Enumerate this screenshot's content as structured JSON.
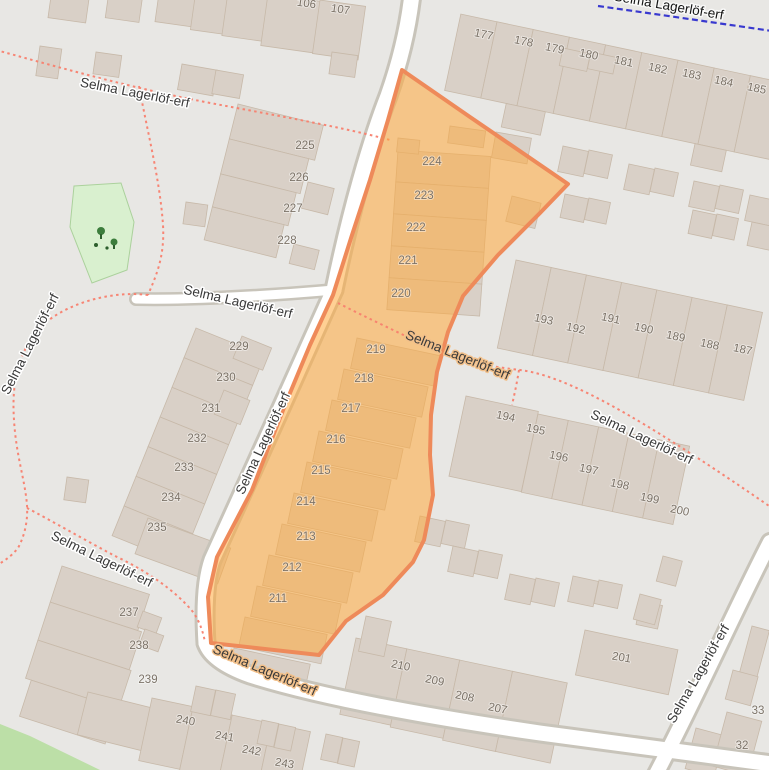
{
  "map": {
    "street_name": "Selma Lagerlöf-erf",
    "street_labels": [
      {
        "text": "Selma Lagerlöf-erf",
        "x": 134,
        "y": 97,
        "rot": 11,
        "kind": "footpath"
      },
      {
        "text": "Selma Lagerlöf-erf",
        "x": 237,
        "y": 306,
        "rot": 13,
        "kind": "road"
      },
      {
        "text": "Selma Lagerlöf-erf",
        "x": 267,
        "y": 445,
        "rot": -65,
        "kind": "road"
      },
      {
        "text": "Selma Lagerlöf-erf",
        "x": 456,
        "y": 359,
        "rot": 22,
        "kind": "footpath-on-selection"
      },
      {
        "text": "Selma Lagerlöf-erf",
        "x": 640,
        "y": 441,
        "rot": 25,
        "kind": "footpath"
      },
      {
        "text": "Selma Lagerlöf-erf",
        "x": 263,
        "y": 674,
        "rot": 23,
        "kind": "road-on-selection"
      },
      {
        "text": "Selma Lagerlöf-erf",
        "x": 34,
        "y": 346,
        "rot": -63,
        "kind": "footpath"
      },
      {
        "text": "Selma Lagerlöf-erf",
        "x": 100,
        "y": 563,
        "rot": 26,
        "kind": "footpath"
      },
      {
        "text": "Selma Lagerlöf-erf",
        "x": 702,
        "y": 676,
        "rot": -60,
        "kind": "road"
      },
      {
        "text": "Selma Lagerlöf-erf",
        "x": 668,
        "y": 10,
        "rot": 10,
        "kind": "cycleway"
      }
    ],
    "house_numbers": [
      {
        "t": "106",
        "x": 306,
        "y": 7,
        "r": 8
      },
      {
        "t": "107",
        "x": 340,
        "y": 13,
        "r": 8
      },
      {
        "t": "177",
        "x": 483,
        "y": 38,
        "r": 12
      },
      {
        "t": "178",
        "x": 523,
        "y": 45,
        "r": 12
      },
      {
        "t": "179",
        "x": 554,
        "y": 52,
        "r": 12
      },
      {
        "t": "180",
        "x": 588,
        "y": 58,
        "r": 12
      },
      {
        "t": "181",
        "x": 623,
        "y": 65,
        "r": 12
      },
      {
        "t": "182",
        "x": 657,
        "y": 72,
        "r": 12
      },
      {
        "t": "183",
        "x": 691,
        "y": 78,
        "r": 12
      },
      {
        "t": "184",
        "x": 723,
        "y": 85,
        "r": 12
      },
      {
        "t": "185",
        "x": 756,
        "y": 92,
        "r": 12
      },
      {
        "t": "225",
        "x": 305,
        "y": 149,
        "r": 0
      },
      {
        "t": "226",
        "x": 299,
        "y": 181,
        "r": 0
      },
      {
        "t": "227",
        "x": 293,
        "y": 212,
        "r": 0
      },
      {
        "t": "228",
        "x": 287,
        "y": 244,
        "r": 0
      },
      {
        "t": "224",
        "x": 432,
        "y": 165,
        "r": 0
      },
      {
        "t": "223",
        "x": 424,
        "y": 199,
        "r": 0
      },
      {
        "t": "222",
        "x": 416,
        "y": 231,
        "r": 0
      },
      {
        "t": "221",
        "x": 408,
        "y": 264,
        "r": 0
      },
      {
        "t": "220",
        "x": 401,
        "y": 297,
        "r": 0
      },
      {
        "t": "219",
        "x": 376,
        "y": 353,
        "r": 0
      },
      {
        "t": "218",
        "x": 364,
        "y": 382,
        "r": 0
      },
      {
        "t": "217",
        "x": 351,
        "y": 412,
        "r": 0
      },
      {
        "t": "216",
        "x": 336,
        "y": 443,
        "r": 0
      },
      {
        "t": "215",
        "x": 321,
        "y": 474,
        "r": 0
      },
      {
        "t": "214",
        "x": 306,
        "y": 505,
        "r": 0
      },
      {
        "t": "213",
        "x": 306,
        "y": 540,
        "r": 0
      },
      {
        "t": "212",
        "x": 292,
        "y": 571,
        "r": 0
      },
      {
        "t": "211",
        "x": 278,
        "y": 602,
        "r": 0
      },
      {
        "t": "229",
        "x": 239,
        "y": 350,
        "r": 0
      },
      {
        "t": "230",
        "x": 226,
        "y": 381,
        "r": 0
      },
      {
        "t": "231",
        "x": 211,
        "y": 412,
        "r": 0
      },
      {
        "t": "232",
        "x": 197,
        "y": 442,
        "r": 0
      },
      {
        "t": "233",
        "x": 184,
        "y": 471,
        "r": 0
      },
      {
        "t": "234",
        "x": 171,
        "y": 501,
        "r": 0
      },
      {
        "t": "235",
        "x": 157,
        "y": 531,
        "r": 0
      },
      {
        "t": "237",
        "x": 129,
        "y": 616,
        "r": 0
      },
      {
        "t": "238",
        "x": 139,
        "y": 649,
        "r": 0
      },
      {
        "t": "239",
        "x": 148,
        "y": 683,
        "r": 0
      },
      {
        "t": "240",
        "x": 185,
        "y": 724,
        "r": 10
      },
      {
        "t": "241",
        "x": 224,
        "y": 740,
        "r": 10
      },
      {
        "t": "242",
        "x": 251,
        "y": 754,
        "r": 10
      },
      {
        "t": "243",
        "x": 284,
        "y": 767,
        "r": 10
      },
      {
        "t": "210",
        "x": 400,
        "y": 669,
        "r": 12
      },
      {
        "t": "209",
        "x": 434,
        "y": 684,
        "r": 12
      },
      {
        "t": "208",
        "x": 464,
        "y": 700,
        "r": 12
      },
      {
        "t": "207",
        "x": 497,
        "y": 712,
        "r": 12
      },
      {
        "t": "193",
        "x": 543,
        "y": 323,
        "r": 12
      },
      {
        "t": "192",
        "x": 575,
        "y": 332,
        "r": 12
      },
      {
        "t": "191",
        "x": 610,
        "y": 322,
        "r": 12
      },
      {
        "t": "190",
        "x": 643,
        "y": 332,
        "r": 12
      },
      {
        "t": "189",
        "x": 675,
        "y": 340,
        "r": 12
      },
      {
        "t": "188",
        "x": 709,
        "y": 348,
        "r": 12
      },
      {
        "t": "187",
        "x": 742,
        "y": 353,
        "r": 12
      },
      {
        "t": "194",
        "x": 505,
        "y": 420,
        "r": 12
      },
      {
        "t": "195",
        "x": 535,
        "y": 433,
        "r": 12
      },
      {
        "t": "196",
        "x": 558,
        "y": 460,
        "r": 12
      },
      {
        "t": "197",
        "x": 588,
        "y": 473,
        "r": 12
      },
      {
        "t": "198",
        "x": 619,
        "y": 488,
        "r": 12
      },
      {
        "t": "199",
        "x": 649,
        "y": 502,
        "r": 12
      },
      {
        "t": "200",
        "x": 679,
        "y": 514,
        "r": 12
      },
      {
        "t": "201",
        "x": 621,
        "y": 661,
        "r": 10
      },
      {
        "t": "33",
        "x": 758,
        "y": 714,
        "r": 0
      },
      {
        "t": "32",
        "x": 742,
        "y": 749,
        "r": 0
      }
    ],
    "colors": {
      "land": "#e8e7e4",
      "building": "#d9d0c7",
      "building_outline": "#c7b9a9",
      "road_fill": "#ffffff",
      "road_casing": "#c8c4ba",
      "footpath": "#f87f6e",
      "cycleway": "#3939cf",
      "park": "#d9f0cf",
      "park_outline": "#abd19c",
      "grass": "#bcdfa7",
      "selection_fill": "rgba(255,170,60,0.55)",
      "selection_stroke": "#ee8a5a",
      "label": "#3a3a3a",
      "housenumber": "#7c7368",
      "tree": "#3c7d3c"
    }
  }
}
